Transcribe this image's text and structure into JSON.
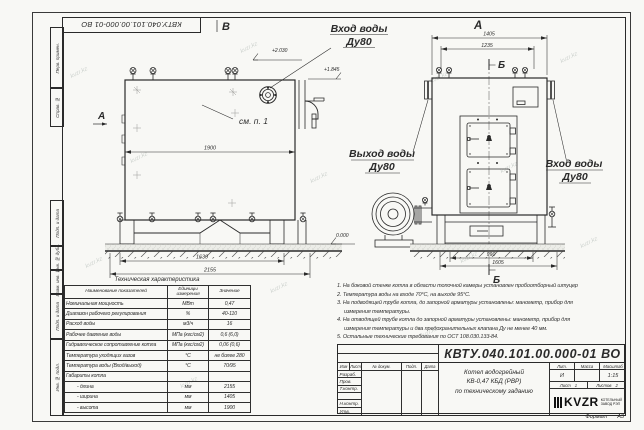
{
  "sheet": {
    "watermark": "kvzr.kz",
    "top_doc_number": "КВТУ.040.101.00.000-01 ВО",
    "format_label": "Формат",
    "format_value": "А3"
  },
  "margin": {
    "items": [
      {
        "label": "Перв. примен."
      },
      {
        "label": "Справ. №"
      },
      {
        "label": "Подп. и дата"
      },
      {
        "label": "Инв. № дубл."
      },
      {
        "label": "Взам. инв. №"
      },
      {
        "label": "Подп. и дата"
      },
      {
        "label": "Инв. № подл."
      }
    ]
  },
  "views": {
    "side": {
      "view_arrow_label": "А",
      "top_view_label": "В",
      "see_note": "см. п. 1",
      "dim_width": "1900",
      "dim_base": "1630",
      "dim_overall": "2155",
      "elev_top": "+2.030",
      "elev_inlet": "+1.845",
      "elev_ground": "0.000"
    },
    "front": {
      "view_label": "А",
      "section_label_top": "Б",
      "section_label_bottom": "Б",
      "dim_overall": "1405",
      "dim_inner": "1235",
      "dim_base": "990",
      "dim_base_overall": "1605"
    }
  },
  "labels": {
    "inlet_top_1": "Вход воды",
    "inlet_top_2": "Ду80",
    "outlet_1": "Выход воды",
    "outlet_2": "Ду80",
    "inlet_right_1": "Вход воды",
    "inlet_right_2": "Ду80"
  },
  "spec_table": {
    "title": "Техническая характеристика",
    "headers": [
      "Наименование показателей",
      "Единицы измерения",
      "Значение"
    ],
    "rows": [
      {
        "name": "Номинальная мощность",
        "unit": "МВт",
        "value": "0,47"
      },
      {
        "name": "Диапазон рабочего регулирования",
        "unit": "%",
        "value": "40-110"
      },
      {
        "name": "Расход воды",
        "unit": "м3/ч",
        "value": "16"
      },
      {
        "name": "Рабочее давление воды",
        "unit": "МПа (кгс/см2)",
        "value": "0,6 (6,0)"
      },
      {
        "name": "Гидравлическое сопротивление котла",
        "unit": "МПа (кгс/см2)",
        "value": "0,06 (0,6)"
      },
      {
        "name": "Температура уходящих газов",
        "unit": "°С",
        "value": "не более 280"
      },
      {
        "name": "Температура воды (Вход/выход)",
        "unit": "°С",
        "value": "70/95"
      },
      {
        "name": "Габариты котла",
        "unit": "",
        "value": ""
      },
      {
        "name": "- длина",
        "unit": "мм",
        "value": "2155"
      },
      {
        "name": "- ширина",
        "unit": "мм",
        "value": "1405"
      },
      {
        "name": "- высота",
        "unit": "мм",
        "value": "1900"
      }
    ]
  },
  "notes": {
    "lines": [
      "1. На боковой стенке котла в области топочной камеры установлен пробоотборный штуцер",
      "2. Температура воды на входе 70°С, на выходе 95°С.",
      "3. На подводящей трубе котла, до запорной арматуры установлены: манометр, прибор для",
      "измерения температуры.",
      "4. На отводящей трубе котла до запорной арматуры установлены: манометр, прибор для",
      "измерения температуры и два предохранительных клапана Ду не менее 40 мм.",
      "5. Остальные технические требования по ОСТ 108.030.133-84."
    ]
  },
  "title_block": {
    "doc_number": "КВТУ.040.101.00.000-01 ВО",
    "name_line1": "Котел водогрейный",
    "name_line2": "КВ-0,47 КБД (РВР)",
    "name_line3": "по техническому заданию",
    "col_lit": "Лит.",
    "col_mass": "Масса",
    "col_scale": "Масштаб",
    "lit_value": "И",
    "scale_value": "1:15",
    "sheet_word": "Лист",
    "sheet_num": "1",
    "sheets_word": "Листов",
    "sheets_num": "2",
    "logo_text": "KVZR",
    "company_line1": "КОТЕЛЬНЫЙ",
    "company_line2": "ЗАВОД РЭП",
    "rev_cols": [
      "Изм",
      "Лист",
      "№ докум.",
      "Подп.",
      "Дата"
    ],
    "roles": [
      "Разраб.",
      "Пров.",
      "Т.контр.",
      "",
      "Н.контр.",
      "Утв."
    ]
  }
}
